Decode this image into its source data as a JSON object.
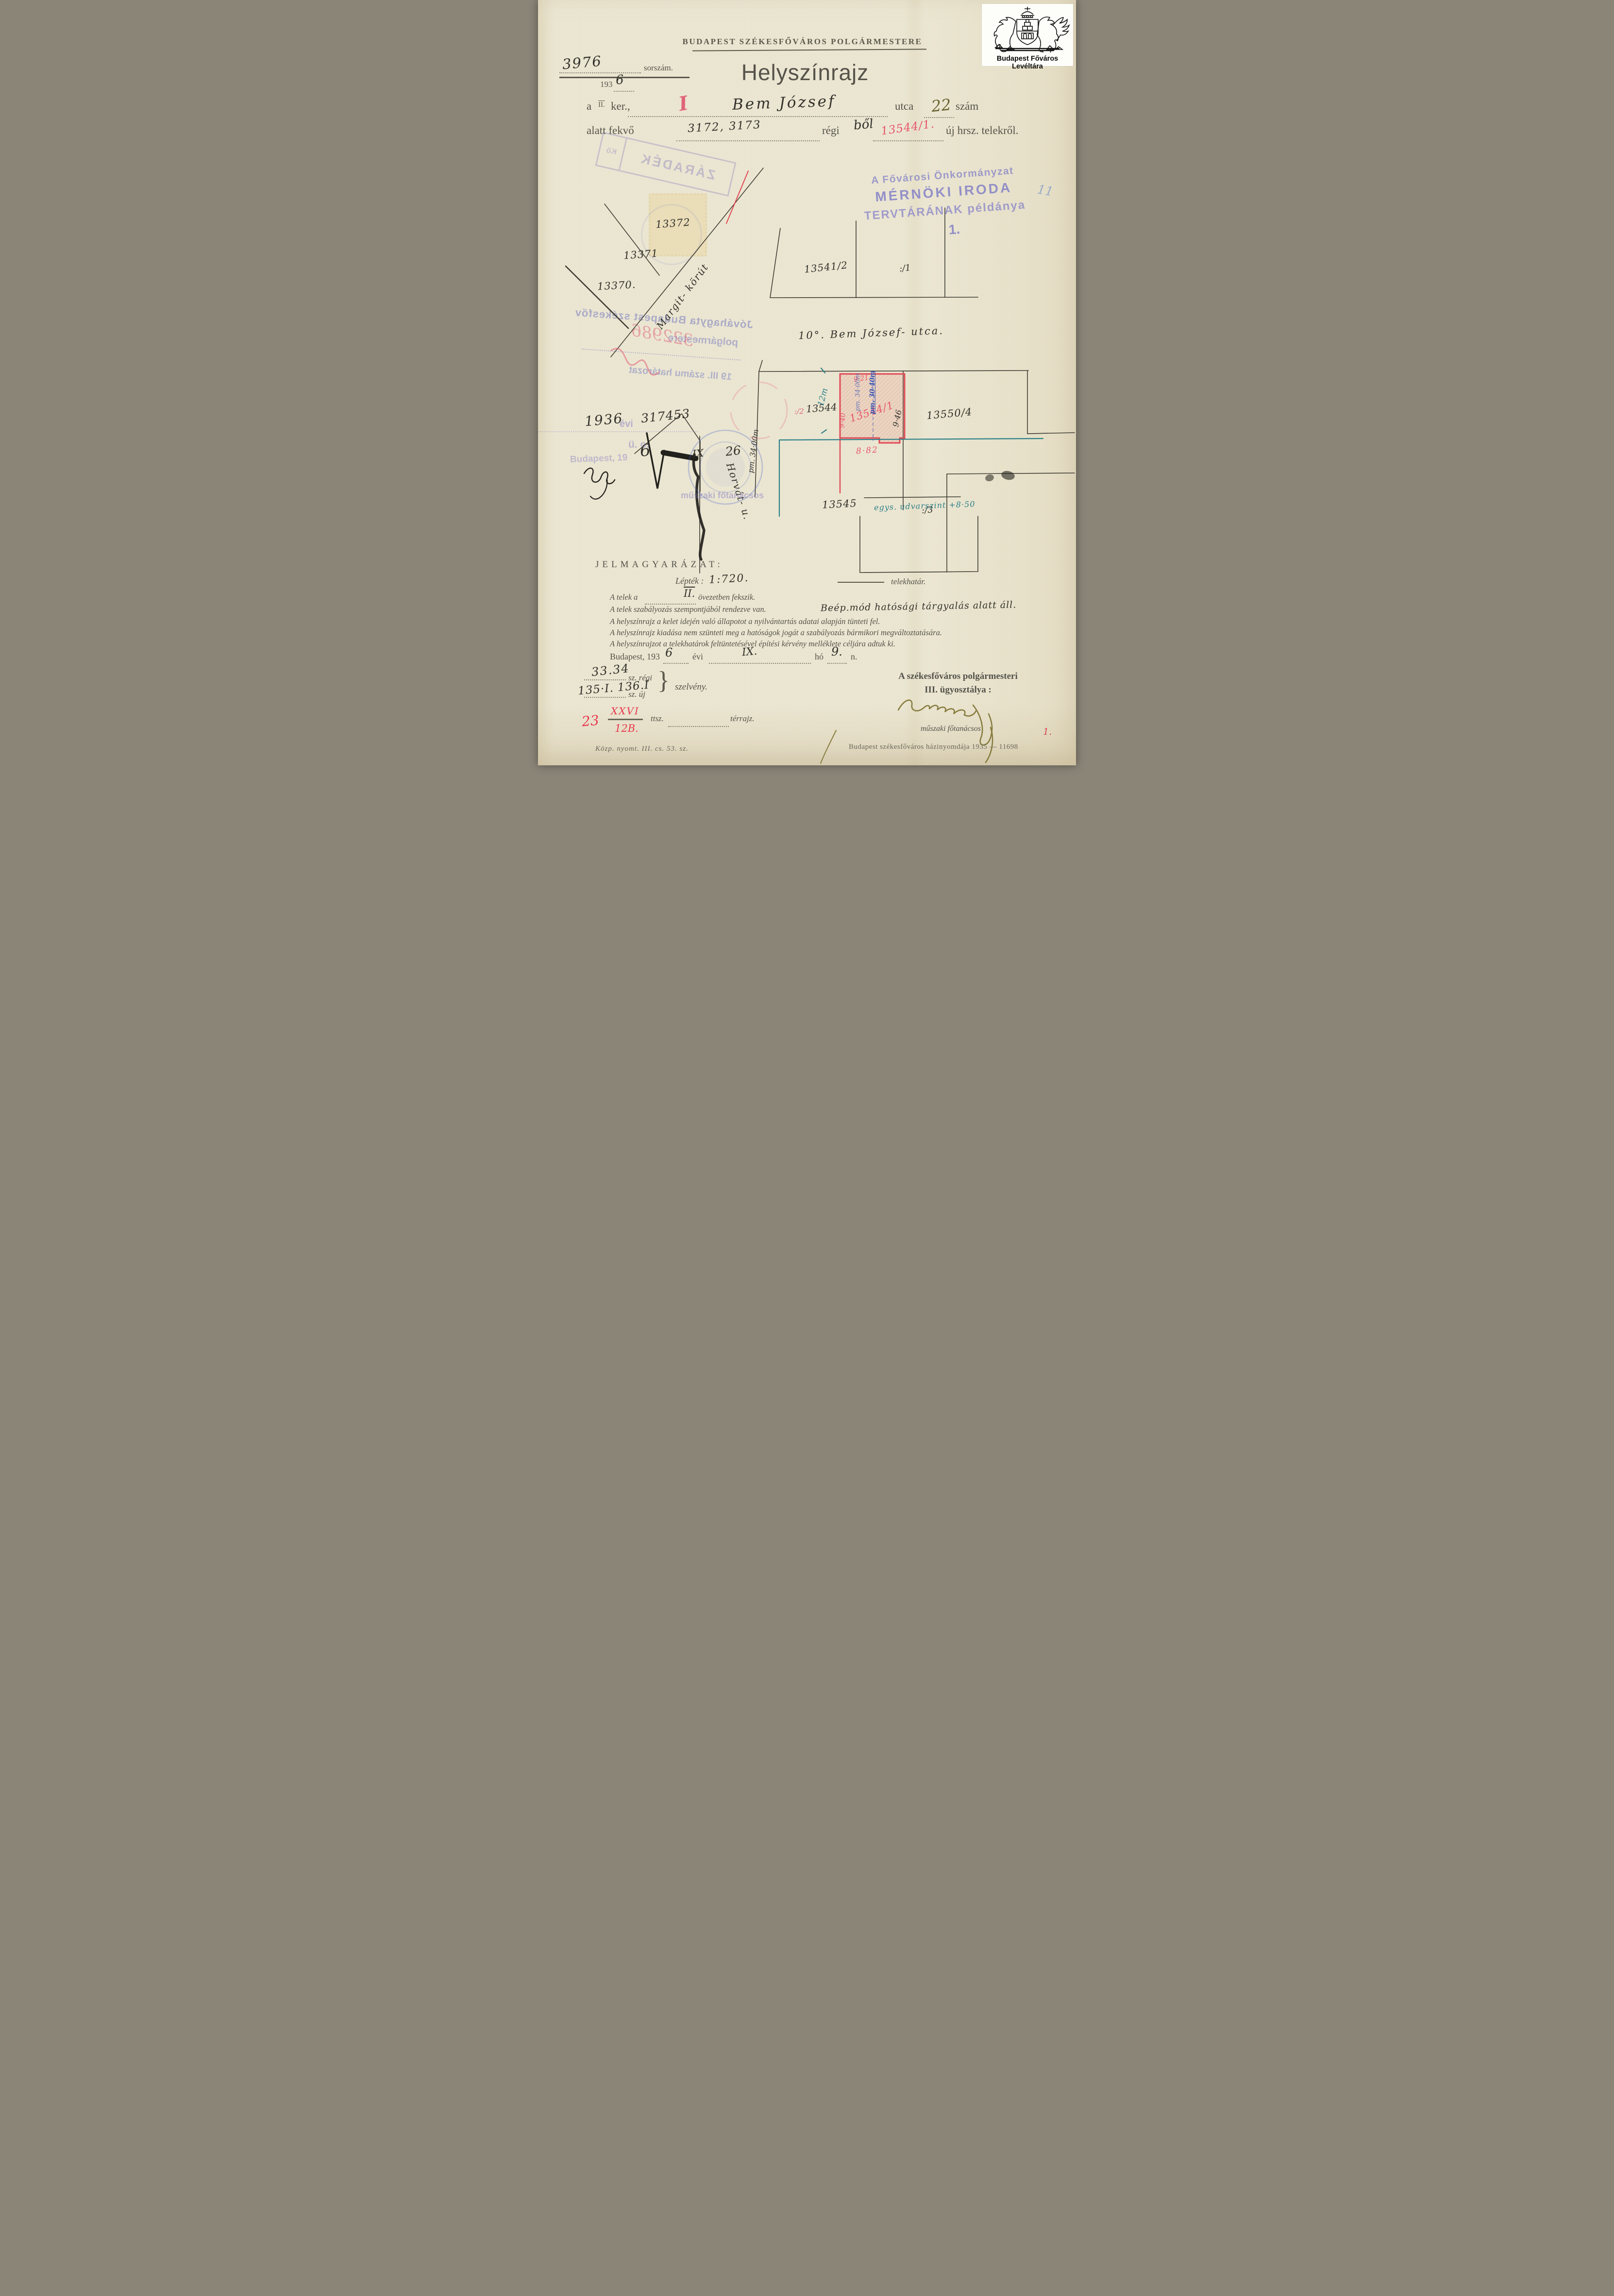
{
  "archive": {
    "name": "Budapest Főváros Levéltára"
  },
  "header": {
    "office": "BUDAPEST SZÉKESFŐVÁROS POLGÁRMESTERE",
    "serial_number": "3976",
    "serial_label": "sorszám.",
    "year_printed": "193",
    "year_handwritten": "6",
    "title": "Helyszínrajz"
  },
  "address": {
    "prefix": "a",
    "district_printed": "II.",
    "district_correction": "I",
    "ker": "ker.,",
    "street_handwritten": "Bem József",
    "utca": "utca",
    "house_number_handwritten": "22",
    "szam": "szám",
    "line2_prefix": "alatt fekvő",
    "old_parcels_handwritten": "3172, 3173",
    "regi": "régi",
    "bol_handwritten": "ből",
    "new_parcel_handwritten": "13544/1.",
    "line2_suffix": "új hrsz. telekről."
  },
  "stamps": {
    "zaradek": "ZÁRADÉK",
    "zaradek_side": "Kö",
    "tervtar_line1": "A Fővárosi Önkormányzat",
    "tervtar_line2": "MÉRNÖKI IRODA",
    "tervtar_line3": "TERVTÁRÁNAK példánya",
    "tervtar_number": "1.",
    "blue_pencil_mark": "11",
    "approval_line1": "Jóváhagyta Budapest székesfőv",
    "approval_line2": "polgármestere",
    "approval_number": "322986",
    "approval_line3": "19    III. számu határozat",
    "evi_stamp": "évi",
    "uo_stamp": "ü. o.",
    "budapest_stamp": "Budapest, 19",
    "muszaki_stamp": "műszaki főtanácsos"
  },
  "map": {
    "plot_13372": "13372",
    "plot_13371": "13371",
    "plot_13370": "13370.",
    "margit_korut": "Margit- körút",
    "plot_13541": "13541/2",
    "plot_sub1": ":/1",
    "street_label": "10°. Bem József- utca.",
    "plot_sub2": ":/2",
    "plot_13544": "13544",
    "plot_13544_1": "13544/1",
    "dim_921": "9·21",
    "dim_pm3400": "pm. 34·00m",
    "dim_pm3040": "pm. 30·40m",
    "dim_940": "9·40",
    "dim_946": "9·46",
    "dim_882": "8·82",
    "dim_12m": "12m",
    "plot_13550": "13550/4",
    "plot_13545": "13545",
    "plot_sub3": ":/3",
    "udvarszint": "egys. udvarszint +8·50",
    "horvat_utca": "Horvát- u.",
    "dim_pm3400_b": "pm. 34·00m",
    "note_1936": "1936",
    "note_317453": "317453",
    "date_day6": "6",
    "date_ix": "IX",
    "date_26": "26"
  },
  "legend": {
    "title": "JELMAGYARÁZAT:",
    "scale_label": "Lépték :",
    "scale_value": "1:720.",
    "telekhatar": "telekhatár.",
    "line1_a": "A telek a",
    "line1_zone": "II.",
    "line1_b": "övezetben fekszik.",
    "line2": "A telek szabályozás szempontjából rendezve van.",
    "line2_handwritten": "Beép.mód hatósági tárgyalás alatt áll.",
    "line3": "A helyszínrajz a kelet idején való állapotot a nyilvántartás adatai alapján tünteti fel.",
    "line4": "A helyszínrajz kiadása nem szünteti meg a hatóságok jogát a szabályozás bármikori megváltoztatására.",
    "line5": "A helyszínrajzot a telekhatárok feltüntetésével építési kérvény melléklete céljára adtuk ki.",
    "date_prefix": "Budapest, 193",
    "date_year": "6",
    "date_evi": "évi",
    "date_month": "IX.",
    "date_ho": "hó",
    "date_day": "9.",
    "date_n": "n."
  },
  "sections": {
    "old_value": "33.34",
    "old_label": "sz. régi",
    "new_value": "135·I. 136.I",
    "new_label": "sz. új",
    "szelveny": "szelvény.",
    "red_23": "23",
    "red_xxvi": "XXVI",
    "red_12b": "12B.",
    "ttsz": "ttsz.",
    "terrajz": "térrajz."
  },
  "signature_block": {
    "dept_line1": "A székesfőváros polgármesteri",
    "dept_line2": "III. ügyosztálya :",
    "title": "műszaki főtanácsos"
  },
  "imprint": {
    "left": "Közp. nyomt. III. cs. 53. sz.",
    "right": "Budapest székesfőváros házinyomdája 1935 — 11698",
    "red_number": "1."
  },
  "colors": {
    "paper": "#ece7d3",
    "printed_ink": "#55534a",
    "handwriting_ink": "#32312b",
    "red_ink": "#d94455",
    "teal_ink": "#2e8087",
    "blue_ink": "#3a55b4",
    "purple_stamp": "#8d8fce",
    "olive_ink": "#877c3e"
  }
}
